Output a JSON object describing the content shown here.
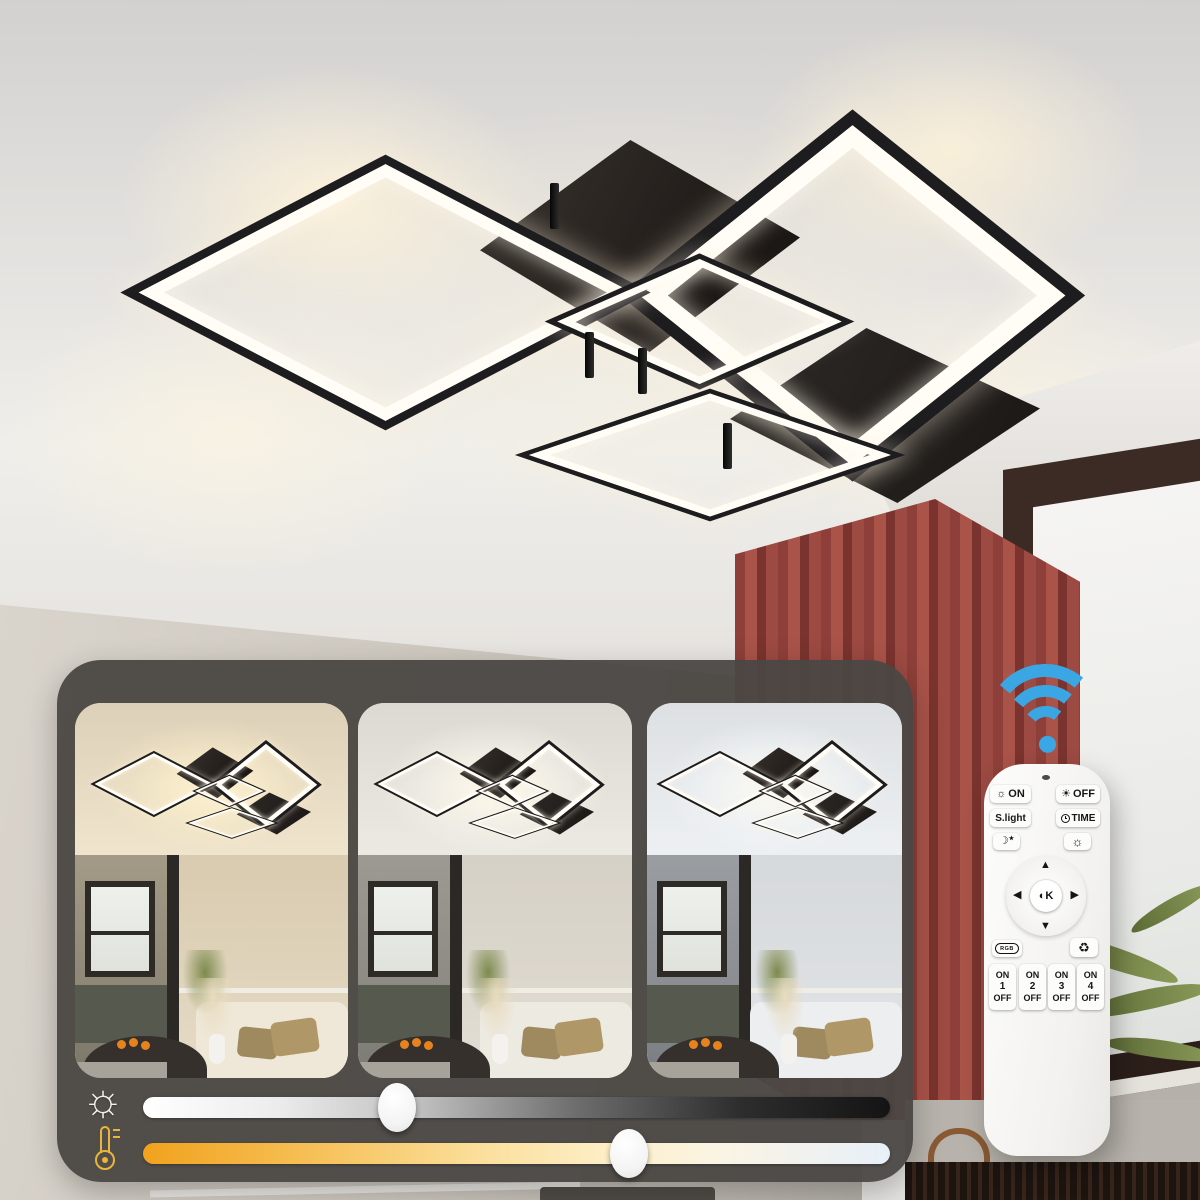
{
  "scene": {
    "thumbnails": [
      {
        "mode": "warm-white"
      },
      {
        "mode": "natural-white"
      },
      {
        "mode": "cool-white"
      }
    ]
  },
  "sliders": {
    "brightness_percent": 34,
    "color_temp_percent": 65
  },
  "remote": {
    "on_label": "ON",
    "off_label": "OFF",
    "scene_label": "S.light",
    "time_label": "TIME",
    "center_label": "K",
    "rgb_label": "RGB",
    "channels": [
      {
        "top": "ON",
        "num": "1",
        "bottom": "OFF"
      },
      {
        "top": "ON",
        "num": "2",
        "bottom": "OFF"
      },
      {
        "top": "ON",
        "num": "3",
        "bottom": "OFF"
      },
      {
        "top": "ON",
        "num": "4",
        "bottom": "OFF"
      }
    ]
  },
  "icons": {
    "sun_outline": "☼",
    "sun_filled": "☀",
    "moon": "☽",
    "star": "★",
    "arrow_up": "▲",
    "arrow_down": "▼",
    "arrow_left": "◀",
    "arrow_right": "▶",
    "half_circle": "◐",
    "recycle": "♻"
  },
  "colors": {
    "wifi_blue": "#3aa7e4",
    "curtain_red": "#9a4a43",
    "slider_gold": "#e9b63b",
    "panel_gray": "#4a4743",
    "lamp_black": "#1d1c1e",
    "led_white": "#fffdf6"
  }
}
